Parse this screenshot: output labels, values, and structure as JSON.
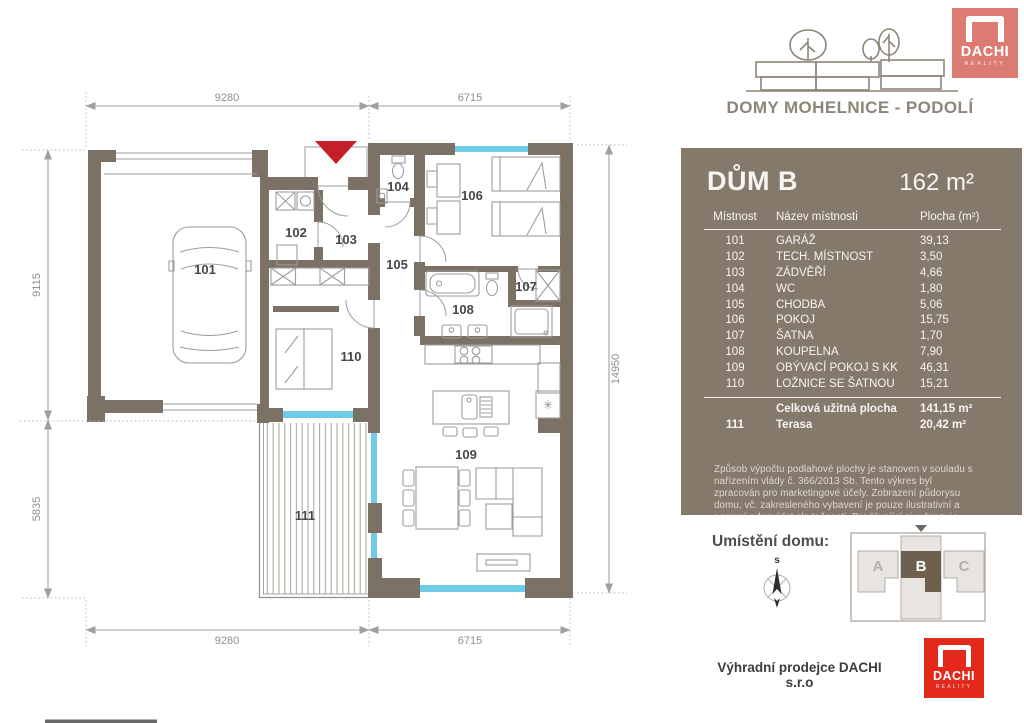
{
  "brand": {
    "name": "DACHI",
    "tagline": "REALITY"
  },
  "header": {
    "project_title": "DOMY MOHELNICE - PODOLÍ"
  },
  "panel": {
    "title": "DŮM B",
    "total_area": "162 m²",
    "table": {
      "columns": [
        "Místnost",
        "Název místnosti",
        "Plocha (m²)"
      ],
      "rows": [
        [
          "101",
          "GARÁŽ",
          "39,13"
        ],
        [
          "102",
          "TECH. MÍSTNOST",
          "3,50"
        ],
        [
          "103",
          "ZÁDVĚŘÍ",
          "4,66"
        ],
        [
          "104",
          "WC",
          "1,80"
        ],
        [
          "105",
          "CHODBA",
          "5,06"
        ],
        [
          "106",
          "POKOJ",
          "15,75"
        ],
        [
          "107",
          "ŠATNA",
          "1,70"
        ],
        [
          "108",
          "KOUPELNA",
          "7,90"
        ],
        [
          "109",
          "OBÝVACÍ POKOJ S KK",
          "46,31"
        ],
        [
          "110",
          "LOŽNICE SE ŠATNOU",
          "15,21"
        ]
      ],
      "summary_total": {
        "label": "Celková užitná plocha",
        "value": "141,15 m²"
      },
      "summary_terrace": {
        "number": "111",
        "label": "Terasa",
        "value": "20,42 m²"
      }
    },
    "disclaimer": "Způsob výpočtu podlahové plochy je stanoven v souladu s nařízením vlády č. 366/2013 Sb. Tento výkres byl zpracován pro marketingové účely. Zobrazení půdorysu domu, vč. zakresleného vybavení je pouze ilustrativní a nemusí odpovídat skutečnosti. Prodávající si vyhrazuje právo na případné změny."
  },
  "location": {
    "label": "Umístění domu:",
    "compass_north": "s",
    "house_a": "A",
    "house_b": "B",
    "house_c": "C"
  },
  "footer": {
    "seller": "Výhradní prodejce DACHI s.r.o"
  },
  "floorplan": {
    "room_labels": [
      "101",
      "102",
      "103",
      "104",
      "105",
      "106",
      "107",
      "108",
      "109",
      "110",
      "111"
    ],
    "dimensions": {
      "top": [
        "9280",
        "6715"
      ],
      "bottom": [
        "9280",
        "6715"
      ],
      "left": [
        "9115",
        "5835"
      ],
      "right": [
        "14950"
      ]
    },
    "boiler_symbol": "✳"
  },
  "colors": {
    "wall": "#7b7164",
    "panel_bg": "#85796c",
    "accent_red": "#c3202a",
    "logo_salmon": "#db7b72",
    "logo_red": "#e2291c",
    "window_cyan": "#6fcce6"
  }
}
